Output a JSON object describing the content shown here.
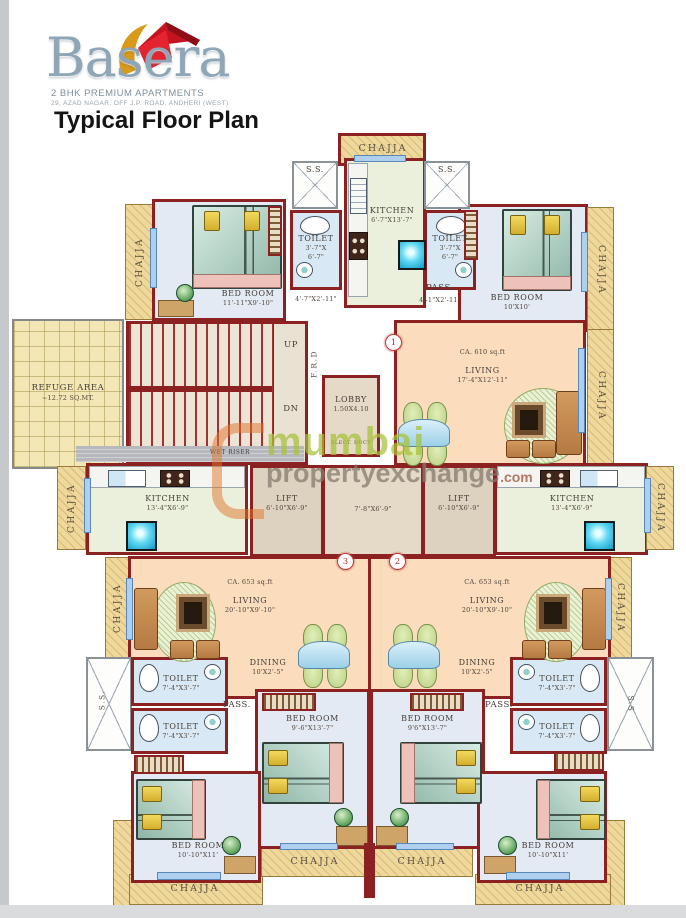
{
  "header": {
    "brand": "Basera",
    "tagline": "2 BHK PREMIUM APARTMENTS",
    "address": "29, AZAD NAGAR, OFF J.P. ROAD, ANDHERI (WEST)",
    "title": "Typical Floor Plan"
  },
  "watermark": {
    "word1": "mumbai",
    "word2": "propertyexchange",
    "suffix": ".com"
  },
  "markers": {
    "m1": "1",
    "m2": "2",
    "m3": "3"
  },
  "labels": {
    "chajja": "CHAJJA",
    "ss": "S.S.",
    "ss_plain": "S.S",
    "pass": "PASS.",
    "up": "UP",
    "dn": "DN",
    "frd": "F.R.D",
    "wet_riser": "WET RISER",
    "elect_duct": "ELECT. DUCT",
    "lift": "LIFT",
    "kitchen": "KITCHEN",
    "toilet": "TOILET",
    "living": "LIVING",
    "dining": "DINING",
    "bedroom": "BED ROOM",
    "lobby": "LOBBY",
    "refuge_1": "REFUGE AREA",
    "refuge_2": "~12.72 SQ.MT."
  },
  "dims": {
    "bedroom_tl": "11'-11\"X9'-10\"",
    "bedroom_tr": "10'X10'",
    "kitchen_top": "6'-7\"X13'-7\"",
    "toilet_top_a": "3'-7\"X",
    "toilet_top_b": "6'-7\"",
    "pass_top_left": "4'-7\"X2'-11\"",
    "pass_top_right": "4'-1\"X2'-11\"",
    "lobby": "1.50X4.10",
    "living1_area": "CA. 610 sq.ft",
    "living1": "17'-4\"X12'-11\"",
    "kitchen_side": "13'-4\"X6'-9\"",
    "lift": "6'-10\"X6'-9\"",
    "lift_lobby": "7'-8\"X6'-9\"",
    "living23_area": "CA. 653 sq.ft",
    "living23": "20'-10\"X9'-10\"",
    "dining": "10'X2'-5\"",
    "toilet_low": "7'-4\"X3'-7\"",
    "bedroom_cl": "9'-6\"X13'-7\"",
    "bedroom_cr": "9'6\"X13'-7\"",
    "bedroom_corner": "10'-10\"X11'"
  },
  "colors": {
    "wall": "#8b2121",
    "living": "#fbdcbc",
    "bedroom": "#e3eaf3",
    "toilet": "#d8e8f4",
    "kitchen": "#eaf0dc",
    "chajja": "#eed89b",
    "refuge": "#f3e7b6",
    "watermark_green": "#a8c238",
    "watermark_gray": "#867a6e"
  }
}
